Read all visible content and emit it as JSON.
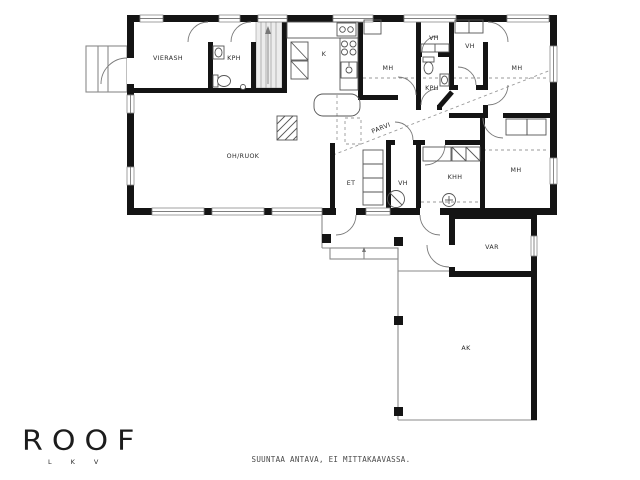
{
  "plan": {
    "rooms": {
      "vierash": "VIERASH",
      "kph_guest": "KPH",
      "kitchen": "K",
      "bedroom_top_mid": "MH",
      "closet_top_1": "VH",
      "closet_top_2": "VH",
      "bathroom_main": "KPH",
      "bedroom_top_right": "MH",
      "living_dining": "OH/RUOK",
      "loft": "PARVI",
      "entry": "ET",
      "closet_entry": "VH",
      "utility": "KHH",
      "bedroom_right": "MH",
      "storage": "VAR",
      "carport": "AK"
    },
    "colors": {
      "wall": "#141414",
      "thin_line": "#8a8a8a",
      "fixture_line": "#555555",
      "label_text": "#2b2b2b"
    }
  },
  "branding": {
    "logo_text": "ROOF",
    "logo_sub": "LKV"
  },
  "footer": {
    "disclaimer": "SUUNTAA ANTAVA, EI MITTAKAAVASSA."
  }
}
